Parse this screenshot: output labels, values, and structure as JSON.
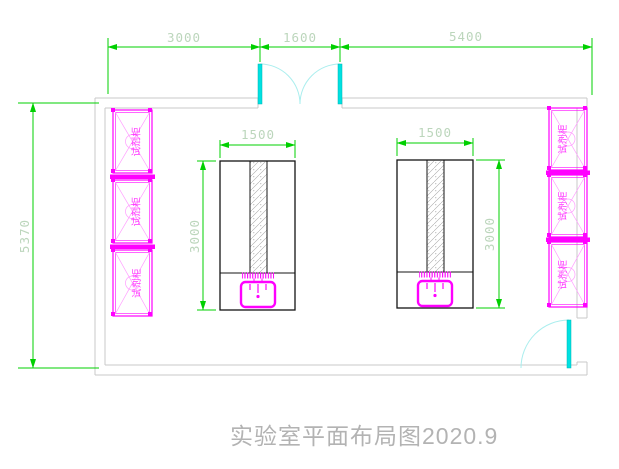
{
  "drawing": {
    "title": "实验室平面布局图2020.9"
  },
  "dimensions": {
    "top": [
      {
        "label": "3000"
      },
      {
        "label": "1600"
      },
      {
        "label": "5400"
      }
    ],
    "left_wall": {
      "label": "5370"
    },
    "bench_left": {
      "width_label": "1500",
      "depth_label": "3000"
    },
    "bench_right": {
      "width_label": "1500",
      "depth_label": "3000"
    }
  },
  "cabinets": {
    "label": "试剂柜",
    "left_column_count": 3,
    "right_column_count": 3
  },
  "colors": {
    "dimension_green": "#00d000",
    "dimension_text": "#bcd6bc",
    "cabinet_magenta": "#ff00ff",
    "door_cyan": "#00e1e1",
    "wall_gray": "#c9c9c9",
    "bench_black": "#141414",
    "title_gray": "#b3b3b3"
  }
}
